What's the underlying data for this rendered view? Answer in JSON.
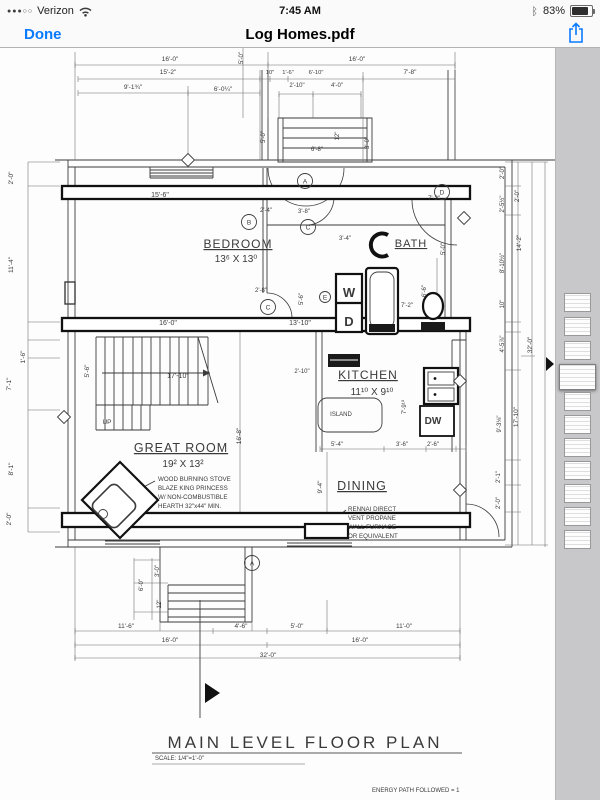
{
  "status_bar": {
    "signal_dots": "●●●○○",
    "carrier": "Verizon",
    "time": "7:45 AM",
    "battery_percent": "83%",
    "icons": {
      "bluetooth": "ᛒ",
      "wifi": "wifi-icon"
    }
  },
  "nav_bar": {
    "done_label": "Done",
    "title": "Log Homes.pdf",
    "share_icon": "share-icon",
    "accent_color": "#0a7aff"
  },
  "sidebar": {
    "thumbnails": [
      {
        "y": 245,
        "selected": false
      },
      {
        "y": 269,
        "selected": false
      },
      {
        "y": 293,
        "selected": false
      },
      {
        "y": 316,
        "selected": true
      },
      {
        "y": 344,
        "selected": false
      },
      {
        "y": 367,
        "selected": false
      },
      {
        "y": 390,
        "selected": false
      },
      {
        "y": 413,
        "selected": false
      },
      {
        "y": 436,
        "selected": false
      },
      {
        "y": 459,
        "selected": false
      },
      {
        "y": 482,
        "selected": false
      }
    ]
  },
  "plan": {
    "title": "MAIN LEVEL FLOOR PLAN",
    "scale_note": "SCALE: 1/4\"=1'-0\"",
    "energy_note": "ENERGY PATH FOLLOWED = 1",
    "line_color": "#3c3c3c",
    "rooms": [
      {
        "name": "BEDROOM",
        "size": "13⁶ X 13⁰"
      },
      {
        "name": "BATH",
        "size": ""
      },
      {
        "name": "KITCHEN",
        "size": "11¹⁰ X 9¹⁰"
      },
      {
        "name": "GREAT ROOM",
        "size": "19² X 13²"
      },
      {
        "name": "DINING",
        "size": ""
      }
    ],
    "labels": [
      {
        "t": "16'-0\"",
        "x": 170,
        "y": 61
      },
      {
        "t": "16'-0\"",
        "x": 357,
        "y": 61
      },
      {
        "t": "15'-2\"",
        "x": 168,
        "y": 74
      },
      {
        "t": "10\"",
        "x": 270,
        "y": 74,
        "s": 5.8
      },
      {
        "t": "1'-6\"",
        "x": 288,
        "y": 74,
        "s": 5.8
      },
      {
        "t": "6'-10\"",
        "x": 316,
        "y": 74,
        "s": 5.8
      },
      {
        "t": "7'-8\"",
        "x": 410,
        "y": 74
      },
      {
        "t": "9'-1¾\"",
        "x": 133,
        "y": 89
      },
      {
        "t": "6'-0¼\"",
        "x": 223,
        "y": 91
      },
      {
        "t": "2'-10\"",
        "x": 297,
        "y": 87,
        "s": 6
      },
      {
        "t": "4'-0\"",
        "x": 337,
        "y": 87,
        "s": 6
      },
      {
        "t": "5'-0\"",
        "x": 243,
        "y": 58,
        "r": -90,
        "s": 6
      },
      {
        "t": "5'-0\"",
        "x": 265,
        "y": 137,
        "r": -90,
        "s": 6
      },
      {
        "t": "6'-8\"",
        "x": 317,
        "y": 151,
        "s": 6
      },
      {
        "t": "12\"",
        "x": 339,
        "y": 136,
        "r": -90,
        "s": 6
      },
      {
        "t": "3'-0\"",
        "x": 369,
        "y": 143,
        "r": -90,
        "s": 6
      },
      {
        "t": "2'-0\"",
        "x": 13,
        "y": 178,
        "r": -90
      },
      {
        "t": "11'-4\"",
        "x": 13,
        "y": 265,
        "r": -90
      },
      {
        "t": "1'-6\"",
        "x": 25,
        "y": 357,
        "r": -90
      },
      {
        "t": "7'-1\"",
        "x": 11,
        "y": 384,
        "r": -90
      },
      {
        "t": "8'-1\"",
        "x": 13,
        "y": 469,
        "r": -90
      },
      {
        "t": "2'-0\"",
        "x": 11,
        "y": 519,
        "r": -90
      },
      {
        "t": "15'-6\"",
        "x": 160,
        "y": 197,
        "s": 7
      },
      {
        "t": "2'-4\"",
        "x": 266,
        "y": 212,
        "s": 6
      },
      {
        "t": "3'-8\"",
        "x": 304,
        "y": 213,
        "s": 6
      },
      {
        "t": "7'-2\"",
        "x": 434,
        "y": 200,
        "s": 6
      },
      {
        "t": "16'-0\"",
        "x": 168,
        "y": 325,
        "s": 7
      },
      {
        "t": "13'-10\"",
        "x": 300,
        "y": 325,
        "s": 7
      },
      {
        "t": "3'-4\"",
        "x": 345,
        "y": 240,
        "s": 6
      },
      {
        "t": "5'-0\"",
        "x": 445,
        "y": 249,
        "r": -90,
        "s": 6
      },
      {
        "t": "2'-8\"",
        "x": 261,
        "y": 292,
        "s": 6
      },
      {
        "t": "5'-6\"",
        "x": 303,
        "y": 299,
        "r": -90,
        "s": 6
      },
      {
        "t": "6'-6\"",
        "x": 426,
        "y": 291,
        "r": -90,
        "s": 6
      },
      {
        "t": "7'-2\"",
        "x": 407,
        "y": 307,
        "s": 6
      },
      {
        "t": "5'-6\"",
        "x": 89,
        "y": 371,
        "r": -90
      },
      {
        "t": "17'-10\"",
        "x": 178,
        "y": 378,
        "s": 7
      },
      {
        "t": "2'-10\"",
        "x": 302,
        "y": 373,
        "s": 6
      },
      {
        "t": "16'-8\"",
        "x": 241,
        "y": 436,
        "r": -90
      },
      {
        "t": "9'-4\"",
        "x": 322,
        "y": 487,
        "r": -90
      },
      {
        "t": "BEDROOM",
        "x": 238,
        "y": 248,
        "s": 12,
        "u": 1,
        "ls": 1,
        "n": "room-label-bedroom"
      },
      {
        "t": "13⁶ X 13⁰",
        "x": 236,
        "y": 262,
        "s": 10,
        "n": "room-dims-bedroom"
      },
      {
        "t": "BATH",
        "x": 411,
        "y": 247,
        "s": 11,
        "u": 1,
        "ls": 1,
        "n": "room-label-bath"
      },
      {
        "t": "KITCHEN",
        "x": 368,
        "y": 379,
        "s": 12,
        "u": 1,
        "ls": 1,
        "n": "room-label-kitchen"
      },
      {
        "t": "11¹⁰ X 9¹⁰",
        "x": 372,
        "y": 395,
        "s": 10,
        "n": "room-dims-kitchen"
      },
      {
        "t": "7'-9¹⁰",
        "x": 406,
        "y": 407,
        "r": -90,
        "s": 6
      },
      {
        "t": "ISLAND",
        "x": 341,
        "y": 416,
        "s": 6,
        "n": "island-label"
      },
      {
        "t": "5'-4\"",
        "x": 337,
        "y": 446,
        "s": 6
      },
      {
        "t": "3'-6\"",
        "x": 402,
        "y": 446,
        "s": 6
      },
      {
        "t": "2'-6\"",
        "x": 433,
        "y": 446,
        "s": 6
      },
      {
        "t": "GREAT ROOM",
        "x": 181,
        "y": 452,
        "s": 12.5,
        "u": 1,
        "ls": 1,
        "n": "room-label-great-room"
      },
      {
        "t": "19² X 13²",
        "x": 183,
        "y": 467,
        "s": 10,
        "n": "room-dims-great-room"
      },
      {
        "t": "DINING",
        "x": 362,
        "y": 490,
        "s": 12.5,
        "u": 1,
        "ls": 1,
        "n": "room-label-dining"
      },
      {
        "t": "UP",
        "x": 107,
        "y": 424,
        "s": 6.5
      },
      {
        "t": "W",
        "x": 349,
        "y": 297,
        "s": 13,
        "b": 1
      },
      {
        "t": "D",
        "x": 349,
        "y": 326,
        "s": 13,
        "b": 1
      },
      {
        "t": "DW",
        "x": 433,
        "y": 424,
        "s": 10,
        "b": 1
      },
      {
        "t": "WOOD BURNING STOVE",
        "x": 158,
        "y": 481,
        "s": 6.2,
        "a": "start",
        "n": "stove-note-line1"
      },
      {
        "t": "BLAZE KING PRINCESS",
        "x": 158,
        "y": 490,
        "s": 6.2,
        "a": "start",
        "n": "stove-note-line2"
      },
      {
        "t": "W/ NON-COMBUSTIBLE",
        "x": 158,
        "y": 499,
        "s": 6.2,
        "a": "start",
        "n": "stove-note-line3"
      },
      {
        "t": "HEARTH 32\"x44\" MIN.",
        "x": 158,
        "y": 508,
        "s": 6.2,
        "a": "start",
        "n": "stove-note-line4"
      },
      {
        "t": "RENNAI DIRECT",
        "x": 348,
        "y": 511,
        "s": 6.2,
        "a": "start",
        "n": "furnace-note-line1"
      },
      {
        "t": "VENT PROPANE",
        "x": 348,
        "y": 520,
        "s": 6.2,
        "a": "start",
        "n": "furnace-note-line2"
      },
      {
        "t": "WALL FURNACE",
        "x": 348,
        "y": 529,
        "s": 6.2,
        "a": "start",
        "n": "furnace-note-line3"
      },
      {
        "t": "OR EQUIVALENT",
        "x": 348,
        "y": 538,
        "s": 6.2,
        "a": "start",
        "n": "furnace-note-line4"
      },
      {
        "t": "2'-0\"",
        "x": 504,
        "y": 173,
        "r": -90,
        "s": 6
      },
      {
        "t": "2'-5½\"",
        "x": 504,
        "y": 204,
        "r": -90,
        "s": 6
      },
      {
        "t": "8'-10½\"",
        "x": 504,
        "y": 263,
        "r": -90,
        "s": 6
      },
      {
        "t": "10\"",
        "x": 504,
        "y": 304,
        "r": -90,
        "s": 6
      },
      {
        "t": "4'-5⅞\"",
        "x": 504,
        "y": 344,
        "r": -90,
        "s": 6
      },
      {
        "t": "9'-3⅛\"",
        "x": 501,
        "y": 424,
        "r": -90,
        "s": 6
      },
      {
        "t": "2'-1\"",
        "x": 500,
        "y": 477,
        "r": -90,
        "s": 6
      },
      {
        "t": "2'-0\"",
        "x": 500,
        "y": 503,
        "r": -90,
        "s": 6
      },
      {
        "t": "2'-0\"",
        "x": 519,
        "y": 196,
        "r": -90,
        "s": 6
      },
      {
        "t": "14'-2\"",
        "x": 521,
        "y": 243,
        "r": -90
      },
      {
        "t": "17'-10\"",
        "x": 518,
        "y": 417,
        "r": -90
      },
      {
        "t": "32'-0\"",
        "x": 532,
        "y": 345,
        "r": -90
      },
      {
        "t": "6'-0\"",
        "x": 143,
        "y": 585,
        "r": -90,
        "s": 6
      },
      {
        "t": "3'-0\"",
        "x": 159,
        "y": 571,
        "r": -90,
        "s": 6
      },
      {
        "t": "12\"",
        "x": 161,
        "y": 604,
        "r": -90,
        "s": 6
      },
      {
        "t": "11'-6\"",
        "x": 126,
        "y": 628
      },
      {
        "t": "4'-6\"",
        "x": 241,
        "y": 628
      },
      {
        "t": "5'-0\"",
        "x": 297,
        "y": 628
      },
      {
        "t": "11'-0\"",
        "x": 404,
        "y": 628
      },
      {
        "t": "16'-0\"",
        "x": 170,
        "y": 642
      },
      {
        "t": "16'-0\"",
        "x": 360,
        "y": 642
      },
      {
        "t": "32'-0\"",
        "x": 268,
        "y": 657
      },
      {
        "t": "MAIN LEVEL FLOOR PLAN",
        "x": 305,
        "y": 748,
        "s": 17,
        "ls": 3,
        "c": "#585858",
        "n": "drawing-title"
      },
      {
        "t": "SCALE: 1/4\"=1'-0\"",
        "x": 155,
        "y": 760,
        "s": 6,
        "a": "start",
        "c": "#585858",
        "n": "drawing-scale"
      },
      {
        "t": "ENERGY PATH FOLLOWED = 1",
        "x": 372,
        "y": 792,
        "s": 6,
        "a": "start",
        "n": "energy-note"
      }
    ],
    "tags": [
      {
        "t": "A",
        "x": 305,
        "y": 181
      },
      {
        "t": "B",
        "x": 249,
        "y": 222
      },
      {
        "t": "C",
        "x": 308,
        "y": 227
      },
      {
        "t": "C",
        "x": 268,
        "y": 307
      },
      {
        "t": "E",
        "x": 325,
        "y": 297,
        "rad": 5.5
      },
      {
        "t": "D",
        "x": 442,
        "y": 192
      },
      {
        "t": "A",
        "x": 252,
        "y": 563
      }
    ],
    "diamond_tags": [
      {
        "x": 188,
        "y": 160
      },
      {
        "x": 464,
        "y": 218
      },
      {
        "x": 64,
        "y": 417
      },
      {
        "x": 460,
        "y": 381
      },
      {
        "x": 460,
        "y": 490
      }
    ]
  }
}
